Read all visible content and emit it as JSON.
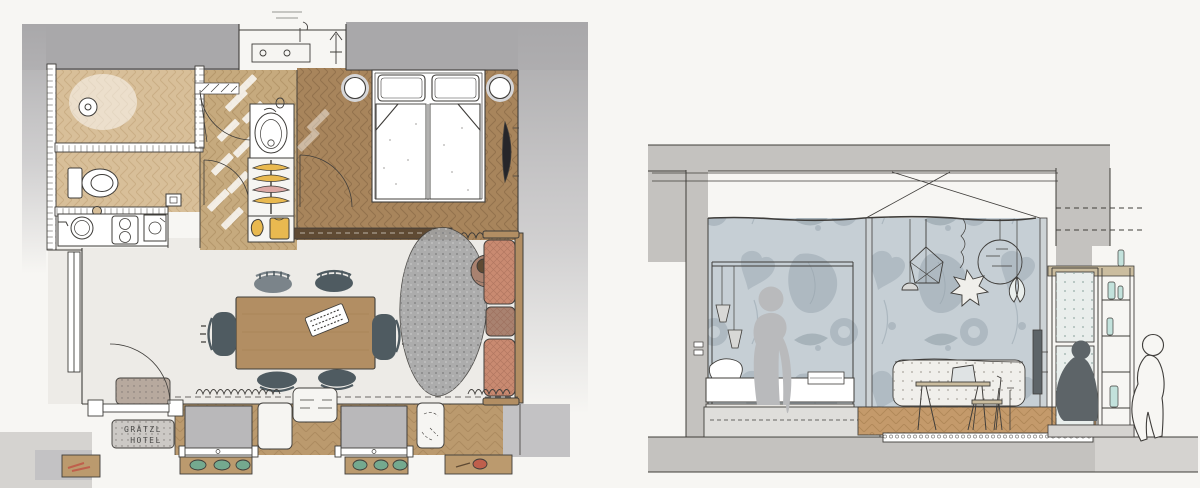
{
  "canvas": {
    "width": 1200,
    "height": 488
  },
  "doormat": {
    "line1": "GRÄTZL",
    "line2": "HOTEL"
  },
  "colors": {
    "paper": "#f7f6f3",
    "ink": "#3f3d3a",
    "ink_soft": "#6b6965",
    "wall": "#a9a8aa",
    "wall_light": "#c3c2c4",
    "slab": "#c4c2bf",
    "ground": "#d5d3d0",
    "wood_bedroom": "#a8855c",
    "wood_bedroom_line": "#7d5f3e",
    "wood_hall": "#c6aa7e",
    "wood_hall_line": "#a08152",
    "wood_bath": "#d8bf99",
    "wood_bath_line": "#b39467",
    "wood_bench": "#bb9a6e",
    "wood_bench_line": "#95764a",
    "wood_section": "#c49a6b",
    "wood_section_line": "#9e7848",
    "floor_living": "#edebe7",
    "counter_white": "#f6f5f2",
    "rug": "#a6a6a6",
    "rug_dot": "#868686",
    "rug_dot_light": "#c6c6c6",
    "sofa": "#c98a71",
    "sofa_mid": "#a98270",
    "sofa_hatch": "#8d5a48",
    "table_wood": "#b28e63",
    "table_wood_line": "#93713f",
    "chair_dark": "#4f5b61",
    "chair_grey": "#7b848a",
    "tv_black": "#26262a",
    "hanger_yellow": "#e9b950",
    "hanger_pink": "#dda8a4",
    "hanger_grey": "#9b9b9b",
    "sash_grey": "#b9b8ba",
    "nightstand_ring": "#d6d6d8",
    "mat_inner": "#b7a99e",
    "mat_outer": "#ccc9c5",
    "mat_dot": "#6f6a66",
    "mat_text": "#4a4a48",
    "plant_green": "#74a98f",
    "flower_red": "#bf5f4c",
    "divider_dark": "#5f4a33",
    "wallpaper_base": "#c6cfd5",
    "wallpaper_motif": "#aeb9c1",
    "wallpaper_deep": "#9aa7b0",
    "post_grey": "#cdd3d6",
    "figure_grey": "#b9babc",
    "figure_dark": "#5d6468",
    "bottle_teal": "#c3e2dc",
    "pane": "#e9eeec",
    "pane_dot": "#9fb3ae",
    "bench_white": "#f0efeb",
    "bench_dot": "#a9a69e",
    "ledge_tan": "#cbbd9f",
    "base_band": "#dfdedb",
    "bed_base": "#e8e6e2",
    "shade_grey": "#d8d8d6",
    "laptop_screen": "#dfe3e4",
    "white": "#ffffff"
  }
}
